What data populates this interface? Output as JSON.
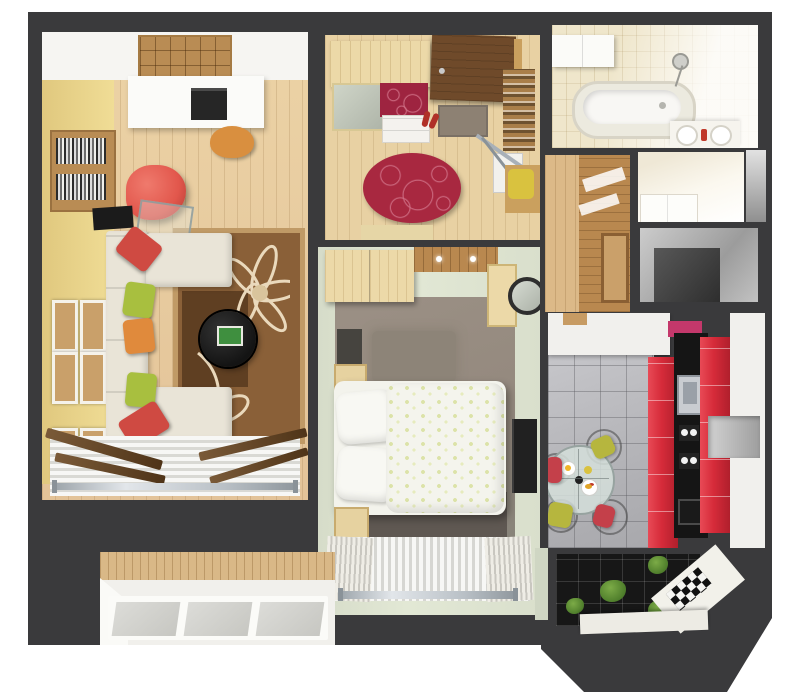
{
  "scene": {
    "title": "3D top-view floor plan render of a one-bedroom apartment",
    "view": "top-down axonometric render",
    "text_visible": "none"
  },
  "palette": {
    "wall": "#3a3a3c",
    "wood": "#e3c398",
    "closet": "#f6f5f2",
    "yellowWall": "#f0dd96",
    "shelfWood": "#b98c54",
    "sofa": "#e9e4d7",
    "pillowRed": "#cf4a42",
    "pillowGreen": "#a8bf3f",
    "pillowOrange": "#e08a3c",
    "chairRed": "#e2574c",
    "rugBrown": "#8a6038",
    "rugBorder": "#c09a66",
    "rugDark": "#5f3f22",
    "rugCream": "#ead9bc",
    "tableBlack": "#141414",
    "hallFloor": "#e8d1a3",
    "doorBrown": "#6f4a2a",
    "matGray": "#8d8173",
    "redRug": "#a82840",
    "redRugLine": "#cf6f85",
    "wardrobeWood": "#ecd9a8",
    "maroon": "#9e2440",
    "bathCream": "#efe6cb",
    "tub": "#f8f7f4",
    "corridorWood": "#dcb988",
    "panelWood": "#b9884f",
    "toiletCream": "#efe8d6",
    "sage": "#e2e8d5",
    "taupe": "#93887d",
    "taupeDark": "#5f5852",
    "bedWhite": "#f3f3ec",
    "bedWood": "#e6d2a0",
    "tvBlack": "#212121",
    "kTile": "#b4b4b8",
    "kRed": "#d62b3a",
    "kBlack": "#151515",
    "kWhite": "#f1f0ed",
    "pink": "#c4386b",
    "steel": "#c9ccd1",
    "cushionGreen": "#b6b63e",
    "cushionRed": "#c4404a",
    "plant": "#4e7d2b",
    "balcWood": "#d9b887",
    "balcFloor": "#f1f0ec",
    "paneGray": "#c7c7c2"
  },
  "rooms": [
    {
      "name": "living-room",
      "label": "Living room",
      "furniture": [
        "white closet area",
        "wooden cube shelving",
        "desk with printer",
        "desk chair",
        "bookshelf with books",
        "red armchair",
        "glass side table",
        "black TV console",
        "U-shaped cream sofa with red, green and orange pillows",
        "brown floral rug",
        "round black coffee table with green book",
        "six framed pictures on yellow wall",
        "window with white blinds and radiator"
      ]
    },
    {
      "name": "hallway",
      "label": "Hallway",
      "furniture": [
        "wardrobe with mirror and maroon panel",
        "entrance door",
        "gray doormat",
        "red shoes",
        "oval red patterned rug",
        "shelving cabinet",
        "ironing board",
        "bench with yellow cushion"
      ]
    },
    {
      "name": "bathroom",
      "label": "Bathroom",
      "furniture": [
        "white cabinet",
        "bathtub",
        "shower head",
        "double sink with red towel"
      ]
    },
    {
      "name": "corridor",
      "label": "Corridor",
      "furniture": [
        "wood panel wall",
        "framed picture"
      ]
    },
    {
      "name": "toilet",
      "label": "Toilet / WC",
      "furniture": [
        "white fixtures"
      ]
    },
    {
      "name": "storage",
      "label": "Storage room",
      "furniture": []
    },
    {
      "name": "bedroom",
      "label": "Bedroom",
      "furniture": [
        "two-door wardrobe",
        "slatted wood ceiling with spotlights",
        "side cabinet",
        "round wall mirror",
        "dark dresser",
        "gray fluffy rug",
        "two nightstands",
        "double bed with speckled white-green duvet and two pillows",
        "wall TV",
        "window with white curtains and radiator"
      ]
    },
    {
      "name": "kitchen",
      "label": "Kitchen",
      "furniture": [
        "white upper cabinets",
        "pink accent panel",
        "gray tile floor",
        "red cabinet runs",
        "black countertop with steel sink, hob and oven",
        "gray open niche",
        "round glass dining table with plates and food",
        "four wire chairs with green and red cushions"
      ]
    },
    {
      "name": "kitchen-bay",
      "label": "Kitchen bay balcony",
      "furniture": [
        "dark glass floor",
        "green plants",
        "white sill",
        "black-and-white checkered corner"
      ]
    },
    {
      "name": "balcony",
      "label": "Balcony",
      "furniture": [
        "wood plank wall",
        "white floor",
        "three gray window panels"
      ]
    }
  ]
}
